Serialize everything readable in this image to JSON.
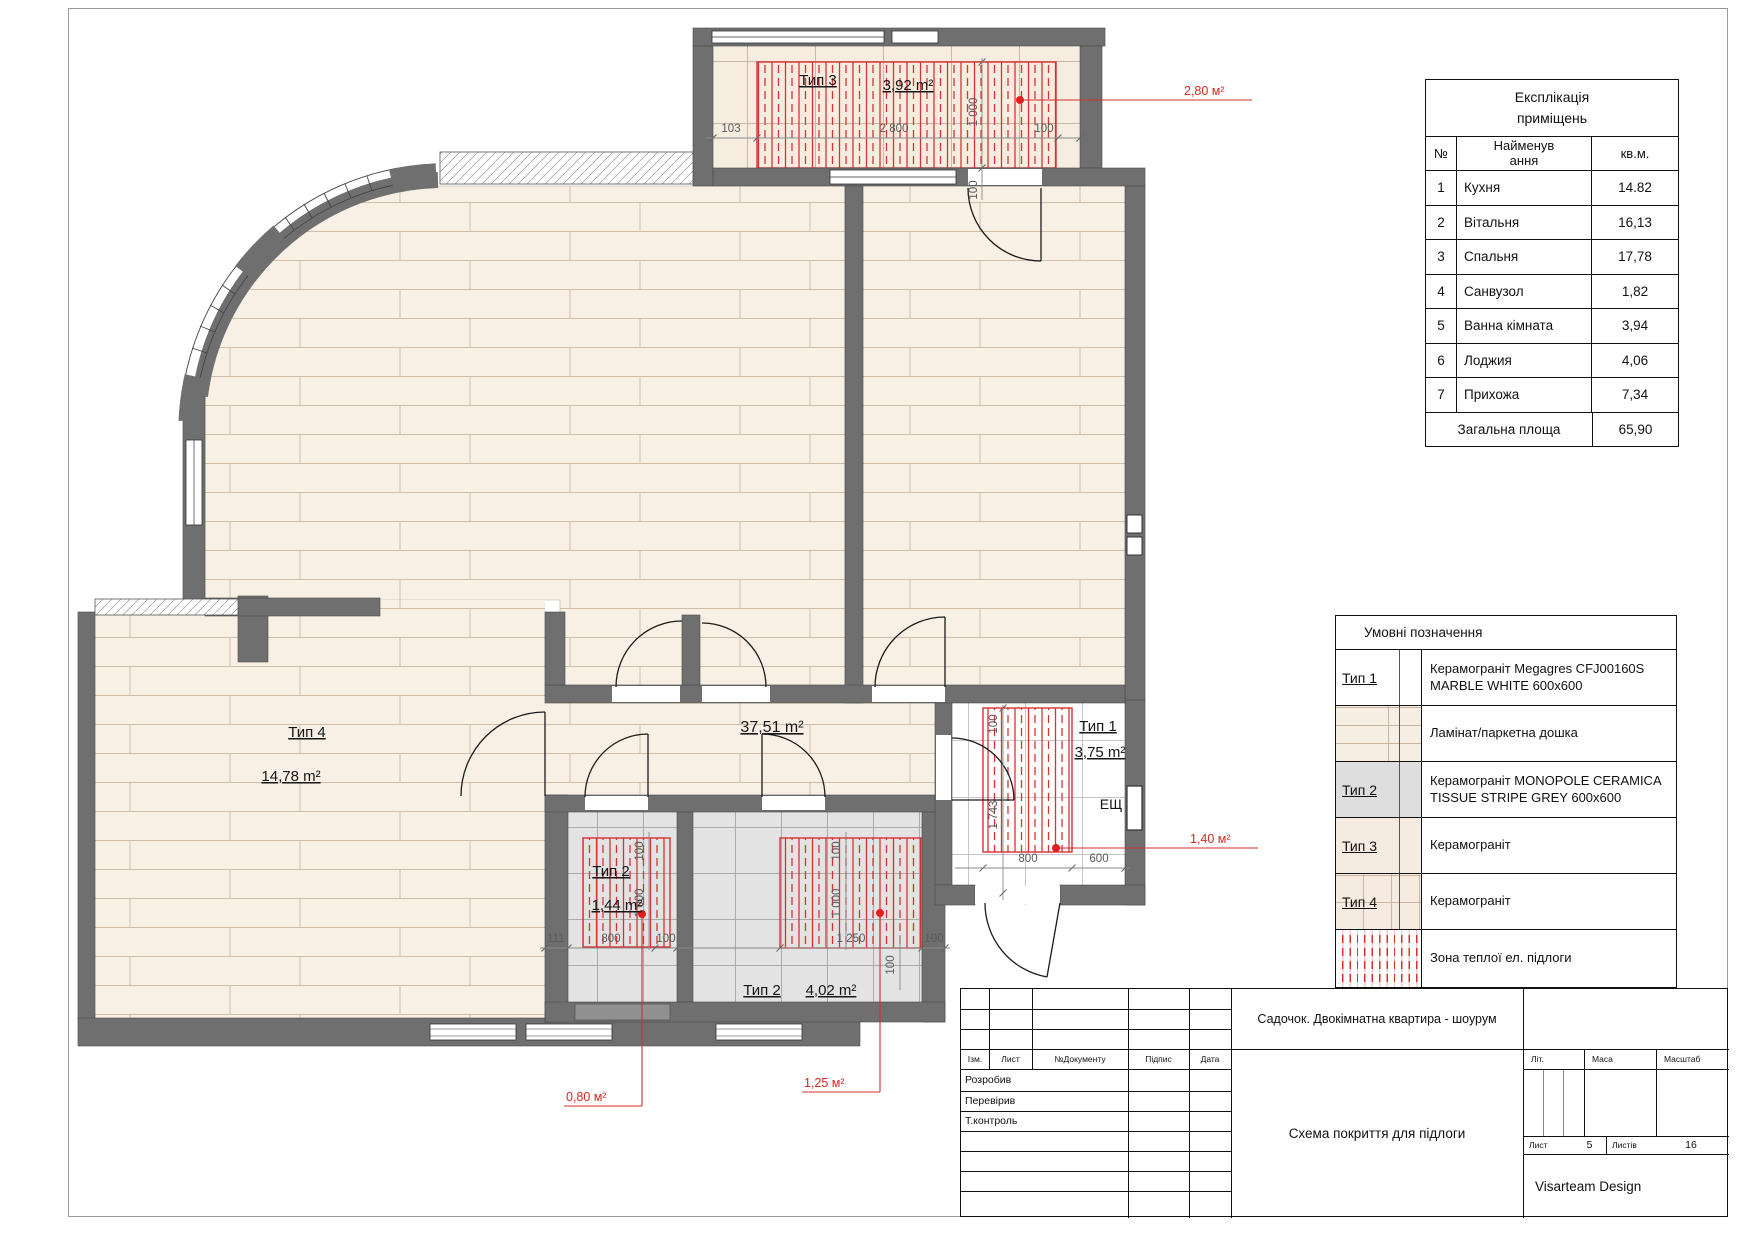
{
  "plan": {
    "labels": {
      "balcony_type": "Тип 3",
      "balcony_area": "3,92 m²",
      "balcony_heat": "2,80 м²",
      "hall_area": "37,51 m²",
      "bath1_type": "Тип 1",
      "bath1_area": "3,75 m²",
      "bath1_heat": "1,40 м²",
      "panel": "ЕЩ",
      "room4_type": "Тип 4",
      "room4_area": "14,78 m²",
      "wc_type": "Тип 2",
      "wc_area": "1,44 m²",
      "wc_heat": "0,80 м²",
      "bath2_type": "Тип 2",
      "bath2_area": "4,02 m²",
      "bath2_heat": "1,25 м²"
    },
    "dims": {
      "d103": "103",
      "d2800": "2 800",
      "d100": "100",
      "d1000": "1 000",
      "d1743": "1 743",
      "d800": "800",
      "d600": "600",
      "d111": "111",
      "d1250": "1 250"
    }
  },
  "explication": {
    "title_1": "Експлікація",
    "title_2": "приміщень",
    "col_no": "№",
    "col_name_1": "Найменув",
    "col_name_2": "ання",
    "col_area": "кв.м.",
    "rows": [
      {
        "n": "1",
        "name": "Кухня",
        "area": "14.82"
      },
      {
        "n": "2",
        "name": "Вітальня",
        "area": "16,13"
      },
      {
        "n": "3",
        "name": "Спальня",
        "area": "17,78"
      },
      {
        "n": "4",
        "name": "Санвузол",
        "area": "1,82"
      },
      {
        "n": "5",
        "name": "Ванна кімната",
        "area": "3,94"
      },
      {
        "n": "6",
        "name": "Лоджия",
        "area": "4,06"
      },
      {
        "n": "7",
        "name": "Прихожа",
        "area": "7,34"
      }
    ],
    "total_label": "Загальна площа",
    "total": "65,90"
  },
  "legend": {
    "title": "Умовні позначення",
    "rows": [
      {
        "label": "Тип 1",
        "text": "Керамограніт Megagres CFJ00160S MARBLE WHITE 600x600"
      },
      {
        "label": "",
        "text": "Ламінат/паркетна дошка"
      },
      {
        "label": "Тип 2",
        "text": "Керамограніт MONOPOLE CERAMICA TISSUE STRIPE GREY 600x600"
      },
      {
        "label": "Тип 3",
        "text": "Керамограніт"
      },
      {
        "label": "Тип 4",
        "text": "Керамограніт"
      },
      {
        "label": "",
        "text": "Зона теплої ел. підлоги"
      }
    ]
  },
  "titleblock": {
    "izm": "Ізм.",
    "list": "Лист",
    "doc": "№Документу",
    "sign": "Підпис",
    "date": "Дата",
    "dev": "Розробив",
    "check": "Перевірив",
    "tcontrol": "Т.контроль",
    "project": "Садочок. Двокімнатна квартира - шоурум",
    "doc_title": "Схема покриття для підлоги",
    "lit": "Літ.",
    "mass": "Маса",
    "scale": "Масштаб",
    "sheet_label": "Лист",
    "sheet_num": "5",
    "sheets_label": "Листів",
    "sheets_num": "16",
    "company": "Visarteam Design"
  },
  "colors": {
    "wall": "#6f6f6f",
    "heat_red": "#d63030",
    "parquet": "#f8efe5",
    "tile_grey": "#e3e3e3"
  }
}
